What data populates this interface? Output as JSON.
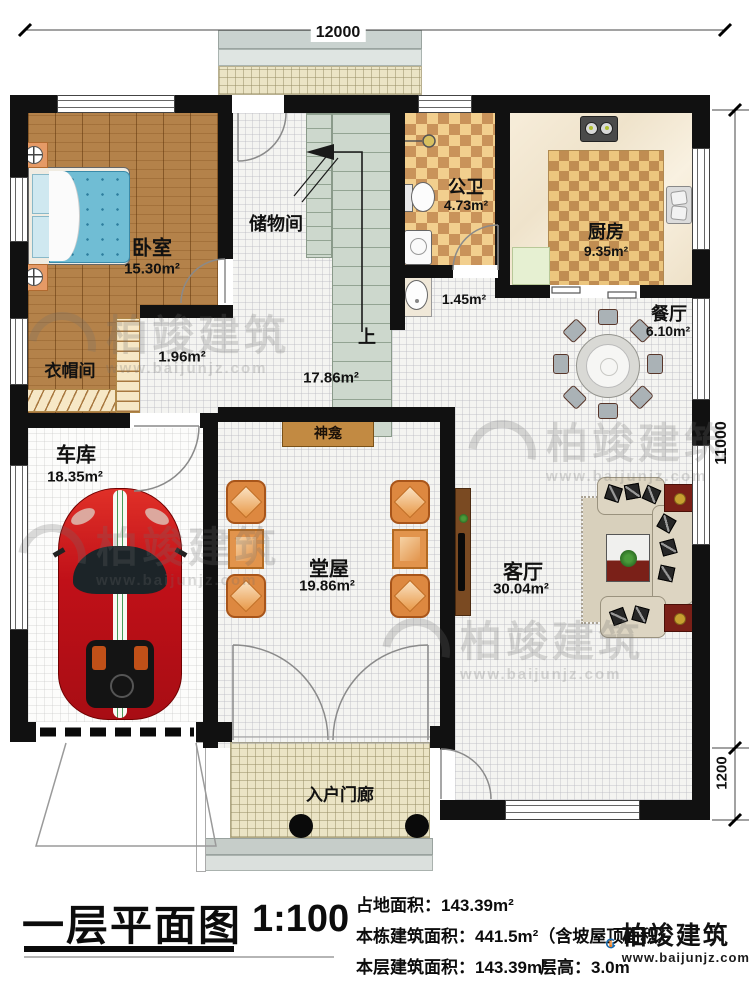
{
  "dims": {
    "top": "12000",
    "right_main": "11000",
    "right_porch": "1200"
  },
  "rooms": {
    "bedroom": {
      "name": "卧室",
      "area": "15.30m²"
    },
    "cloakroom": {
      "name": "衣帽间"
    },
    "vestibule": {
      "area": "1.96m²"
    },
    "storage": {
      "name": "储物间"
    },
    "stairs": {
      "up": "上"
    },
    "hall": {
      "area": "17.86m²"
    },
    "bathroom": {
      "name": "公卫",
      "area": "4.73m²"
    },
    "bath_lobby": {
      "area": "1.45m²"
    },
    "kitchen": {
      "name": "厨房",
      "area": "9.35m²"
    },
    "dining": {
      "name": "餐厅",
      "area": "6.10m²"
    },
    "garage": {
      "name": "车库",
      "area": "18.35m²"
    },
    "main_hall": {
      "name": "堂屋",
      "area": "19.86m²"
    },
    "shrine": {
      "name": "神龛"
    },
    "living": {
      "name": "客厅",
      "area": "30.04m²"
    },
    "porch": {
      "name": "入户门廊"
    }
  },
  "title_block": {
    "title": "一层平面图",
    "scale": "1:100",
    "land_area": "占地面积：143.39m²",
    "total_area": "本栋建筑面积：441.5m²（含坡屋顶面积）",
    "floor_area": "本层建筑面积：143.39m²",
    "floor_height": "层高：3.0m"
  },
  "brand": {
    "name": "柏竣建筑",
    "url": "www.baijunjz.com"
  },
  "colors": {
    "wall": "#111111",
    "wood": "#b4824a",
    "bed": "#74c0d6",
    "check_dark": "#c9935a",
    "check_light": "#f2cf8e",
    "stairs": "#cdd8cd",
    "car": "#c81420",
    "brand_blue": "#1668aa",
    "brand_orange": "#e87818"
  }
}
